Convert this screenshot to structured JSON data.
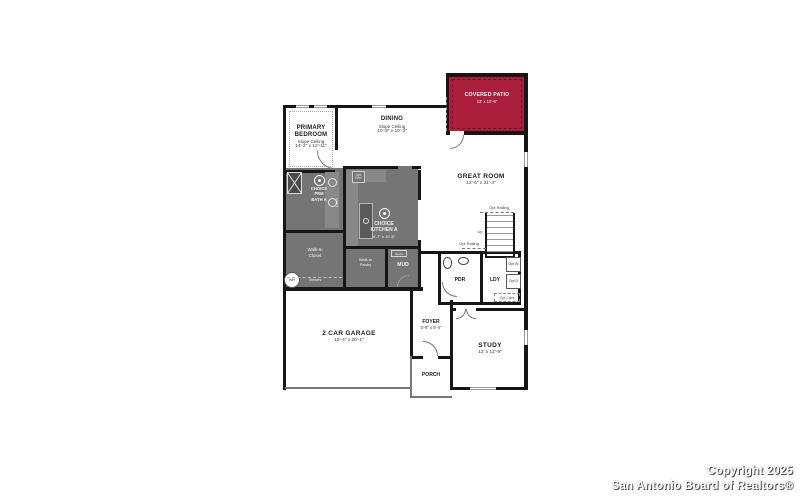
{
  "colors": {
    "patio_red": "#ab1f3d",
    "option_room_gray": "#757575",
    "wall_black": "#161616",
    "background": "#ffffff"
  },
  "rooms": {
    "covered_patio": {
      "name": "COVERED PATIO",
      "dims": "13' x 10'-6\""
    },
    "primary_bedroom": {
      "name": "PRIMARY BEDROOM",
      "ceiling": "Slope Ceiling",
      "dims": "14'-2\" x 12'-11\""
    },
    "dining": {
      "name": "DINING",
      "ceiling": "Slope Ceiling",
      "dims": "10'-9\" x 10'-3\""
    },
    "great_room": {
      "name": "GREAT ROOM",
      "dims": "12'-6\" x 21'-4\""
    },
    "choice_prm_bath": {
      "line1": "CHOICE",
      "line2": "PRM",
      "line3": "BATH A"
    },
    "choice_kitchen": {
      "line1": "CHOICE",
      "line2": "KITCHEN A",
      "dims": "9'-7\" x 10'-5\""
    },
    "walk_in_closet": {
      "line1": "Walk-In",
      "line2": "Closet"
    },
    "walk_in_pantry": {
      "line1": "Walk-in",
      "line2": "Pantry"
    },
    "mud": {
      "name": "MUD"
    },
    "pdr": {
      "name": "PDR"
    },
    "ldy": {
      "name": "LDY"
    },
    "garage": {
      "name": "2 CAR GARAGE",
      "dims": "19'-4\" x 20'-1\""
    },
    "foyer": {
      "name": "FOYER",
      "dims": "5'-8\" x 8'-4\""
    },
    "study": {
      "name": "STUDY",
      "dims": "12' x 12'-9\""
    },
    "porch": {
      "name": "PORCH"
    }
  },
  "annotations": {
    "opt_railing": "Opt Railing",
    "up": "Up",
    "opt_w": "Opt W",
    "opt_d": "Opt D",
    "opt_cabs": "Opt Cabs",
    "opt_elev": "Opt Elev",
    "linen": "Linen",
    "shelves": "Shelves",
    "hooks": "Hooks",
    "wh": "WH"
  },
  "footer": {
    "line1": "Copyright 2025",
    "line2": "San Antonio Board of Realtors®"
  }
}
